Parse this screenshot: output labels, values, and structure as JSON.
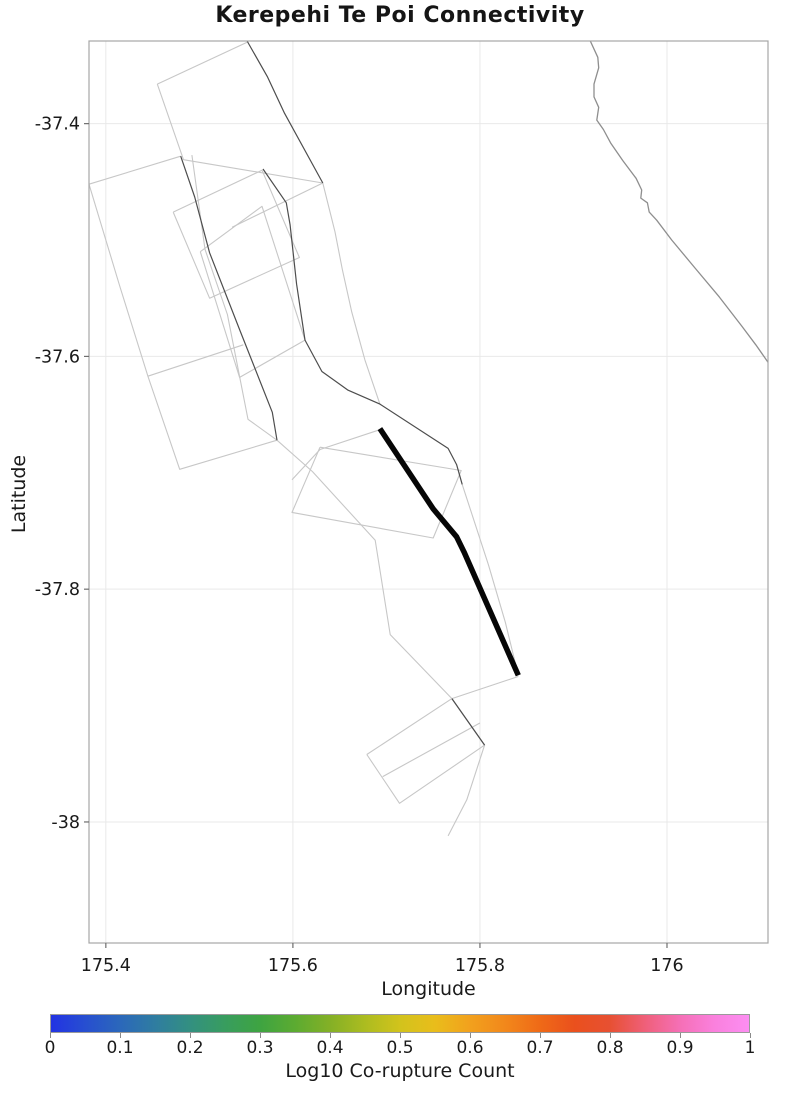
{
  "title": "Kerepehi Te Poi Connectivity",
  "chart_data": {
    "type": "line",
    "subtype": "geographic-fault-map",
    "title": "Kerepehi Te Poi Connectivity",
    "xlabel": "Longitude",
    "ylabel": "Latitude",
    "xlim": [
      175.382,
      176.108
    ],
    "ylim": [
      -38.104,
      -37.329
    ],
    "grid": true,
    "x_ticks": [
      175.4,
      175.6,
      175.8,
      176
    ],
    "x_tick_labels": [
      "175.4",
      "175.6",
      "175.8",
      "176"
    ],
    "y_ticks": [
      -37.4,
      -37.6,
      -37.8,
      -38
    ],
    "y_tick_labels": [
      "-37.4",
      "-37.6",
      "-37.8",
      "-38"
    ],
    "colors": {
      "highlight": "#060606",
      "dark_trace": "#4d4d4d",
      "light_trace": "#c7c7c7",
      "coastline": "#8e8e8e",
      "gridline": "#e9e9e9",
      "spine": "#a6a6a6",
      "tick": "#6e6e6e"
    },
    "highlighted_fault": {
      "name": "Kerepehi Te Poi",
      "stroke_width": 5.5,
      "points": [
        [
          175.693,
          -37.662
        ],
        [
          175.75,
          -37.731
        ],
        [
          175.775,
          -37.755
        ],
        [
          175.783,
          -37.768
        ],
        [
          175.841,
          -37.874
        ]
      ]
    },
    "coastline": {
      "points": [
        [
          175.918,
          -37.329
        ],
        [
          175.926,
          -37.343
        ],
        [
          175.927,
          -37.352
        ],
        [
          175.922,
          -37.366
        ],
        [
          175.922,
          -37.377
        ],
        [
          175.927,
          -37.386
        ],
        [
          175.925,
          -37.397
        ],
        [
          175.932,
          -37.405
        ],
        [
          175.94,
          -37.417
        ],
        [
          175.953,
          -37.432
        ],
        [
          175.967,
          -37.447
        ],
        [
          175.973,
          -37.457
        ],
        [
          175.972,
          -37.464
        ],
        [
          175.979,
          -37.468
        ],
        [
          175.981,
          -37.476
        ],
        [
          175.989,
          -37.483
        ],
        [
          176.005,
          -37.5
        ],
        [
          176.03,
          -37.524
        ],
        [
          176.056,
          -37.549
        ],
        [
          176.08,
          -37.574
        ],
        [
          176.095,
          -37.59
        ],
        [
          176.108,
          -37.605
        ]
      ]
    },
    "fault_traces": [
      {
        "shade": "dark",
        "points": [
          [
            175.48,
            -37.428
          ],
          [
            175.495,
            -37.463
          ],
          [
            175.511,
            -37.511
          ],
          [
            175.543,
            -37.577
          ],
          [
            175.578,
            -37.648
          ],
          [
            175.583,
            -37.672
          ]
        ]
      },
      {
        "shade": "dark",
        "points": [
          [
            175.551,
            -37.329
          ],
          [
            175.573,
            -37.36
          ],
          [
            175.591,
            -37.391
          ],
          [
            175.632,
            -37.451
          ]
        ]
      },
      {
        "shade": "dark",
        "points": [
          [
            175.568,
            -37.439
          ],
          [
            175.593,
            -37.468
          ],
          [
            175.597,
            -37.487
          ],
          [
            175.604,
            -37.538
          ],
          [
            175.613,
            -37.586
          ],
          [
            175.631,
            -37.613
          ],
          [
            175.659,
            -37.629
          ],
          [
            175.693,
            -37.641
          ],
          [
            175.766,
            -37.679
          ],
          [
            175.775,
            -37.693
          ],
          [
            175.781,
            -37.71
          ]
        ]
      },
      {
        "shade": "dark",
        "points": [
          [
            175.77,
            -37.894
          ],
          [
            175.805,
            -37.934
          ]
        ]
      },
      {
        "shade": "light",
        "points": [
          [
            175.455,
            -37.366
          ],
          [
            175.551,
            -37.33
          ]
        ]
      },
      {
        "shade": "light",
        "points": [
          [
            175.632,
            -37.451
          ],
          [
            175.483,
            -37.431
          ],
          [
            175.455,
            -37.366
          ]
        ]
      },
      {
        "shade": "light",
        "points": [
          [
            175.382,
            -37.452
          ],
          [
            175.48,
            -37.428
          ]
        ]
      },
      {
        "shade": "light",
        "points": [
          [
            175.382,
            -37.452
          ],
          [
            175.415,
            -37.54
          ],
          [
            175.445,
            -37.617
          ],
          [
            175.479,
            -37.697
          ],
          [
            175.583,
            -37.672
          ]
        ]
      },
      {
        "shade": "light",
        "points": [
          [
            175.445,
            -37.617
          ],
          [
            175.547,
            -37.59
          ]
        ]
      },
      {
        "shade": "light",
        "points": [
          [
            175.472,
            -37.476
          ],
          [
            175.567,
            -37.44
          ],
          [
            175.607,
            -37.515
          ],
          [
            175.511,
            -37.55
          ],
          [
            175.472,
            -37.476
          ]
        ]
      },
      {
        "shade": "light",
        "points": [
          [
            175.535,
            -37.489
          ],
          [
            175.632,
            -37.451
          ]
        ]
      },
      {
        "shade": "light",
        "points": [
          [
            175.501,
            -37.51
          ],
          [
            175.567,
            -37.471
          ],
          [
            175.613,
            -37.586
          ],
          [
            175.543,
            -37.618
          ],
          [
            175.501,
            -37.51
          ]
        ]
      },
      {
        "shade": "light",
        "points": [
          [
            175.492,
            -37.427
          ],
          [
            175.506,
            -37.508
          ],
          [
            175.53,
            -37.564
          ],
          [
            175.552,
            -37.654
          ],
          [
            175.583,
            -37.672
          ]
        ]
      },
      {
        "shade": "light",
        "points": [
          [
            175.632,
            -37.451
          ],
          [
            175.645,
            -37.493
          ],
          [
            175.653,
            -37.526
          ],
          [
            175.663,
            -37.562
          ],
          [
            175.677,
            -37.603
          ],
          [
            175.693,
            -37.641
          ]
        ]
      },
      {
        "shade": "light",
        "points": [
          [
            175.629,
            -37.678
          ],
          [
            175.78,
            -37.698
          ],
          [
            175.75,
            -37.756
          ],
          [
            175.599,
            -37.734
          ],
          [
            175.629,
            -37.678
          ]
        ]
      },
      {
        "shade": "light",
        "points": [
          [
            175.693,
            -37.663
          ],
          [
            175.629,
            -37.68
          ],
          [
            175.599,
            -37.706
          ]
        ]
      },
      {
        "shade": "light",
        "points": [
          [
            175.583,
            -37.672
          ],
          [
            175.621,
            -37.699
          ],
          [
            175.688,
            -37.758
          ],
          [
            175.704,
            -37.839
          ],
          [
            175.77,
            -37.894
          ]
        ]
      },
      {
        "shade": "light",
        "points": [
          [
            175.781,
            -37.71
          ],
          [
            175.809,
            -37.779
          ],
          [
            175.827,
            -37.828
          ],
          [
            175.841,
            -37.874
          ]
        ]
      },
      {
        "shade": "light",
        "points": [
          [
            175.77,
            -37.894
          ],
          [
            175.841,
            -37.875
          ]
        ]
      },
      {
        "shade": "light",
        "points": [
          [
            175.679,
            -37.942
          ],
          [
            175.77,
            -37.894
          ],
          [
            175.805,
            -37.934
          ],
          [
            175.714,
            -37.984
          ],
          [
            175.679,
            -37.942
          ]
        ]
      },
      {
        "shade": "light",
        "points": [
          [
            175.696,
            -37.961
          ],
          [
            175.8,
            -37.915
          ]
        ]
      },
      {
        "shade": "light",
        "points": [
          [
            175.805,
            -37.934
          ],
          [
            175.786,
            -37.981
          ],
          [
            175.766,
            -38.012
          ]
        ]
      }
    ],
    "colorbar": {
      "label": "Log10 Co-rupture Count",
      "tick_labels": [
        "0",
        "0.1",
        "0.2",
        "0.3",
        "0.4",
        "0.5",
        "0.6",
        "0.7",
        "0.8",
        "0.9",
        "1"
      ],
      "tick_values": [
        0,
        0.1,
        0.2,
        0.3,
        0.4,
        0.5,
        0.6,
        0.7,
        0.8,
        0.9,
        1
      ],
      "range": [
        0,
        1
      ],
      "gradient_stops": [
        [
          0.0,
          "#2233e3"
        ],
        [
          0.05,
          "#274fd0"
        ],
        [
          0.1,
          "#2b68ba"
        ],
        [
          0.15,
          "#2f7da0"
        ],
        [
          0.2,
          "#339080"
        ],
        [
          0.25,
          "#389d5e"
        ],
        [
          0.3,
          "#3ea441"
        ],
        [
          0.35,
          "#5cab31"
        ],
        [
          0.4,
          "#84b026"
        ],
        [
          0.45,
          "#acbc20"
        ],
        [
          0.5,
          "#d2c31c"
        ],
        [
          0.55,
          "#e9bd1b"
        ],
        [
          0.6,
          "#f2a11d"
        ],
        [
          0.65,
          "#f2881b"
        ],
        [
          0.7,
          "#ef6a17"
        ],
        [
          0.75,
          "#ea501d"
        ],
        [
          0.8,
          "#e75032"
        ],
        [
          0.85,
          "#ef5f78"
        ],
        [
          0.9,
          "#f56fb5"
        ],
        [
          0.95,
          "#fa80dd"
        ],
        [
          1.0,
          "#fc8ef2"
        ]
      ]
    }
  },
  "layout": {
    "plot_box": {
      "left": 89,
      "top": 41,
      "width": 679,
      "height": 902
    },
    "colorbar_box": {
      "left": 50,
      "top": 1014,
      "width": 700,
      "height": 19
    }
  }
}
